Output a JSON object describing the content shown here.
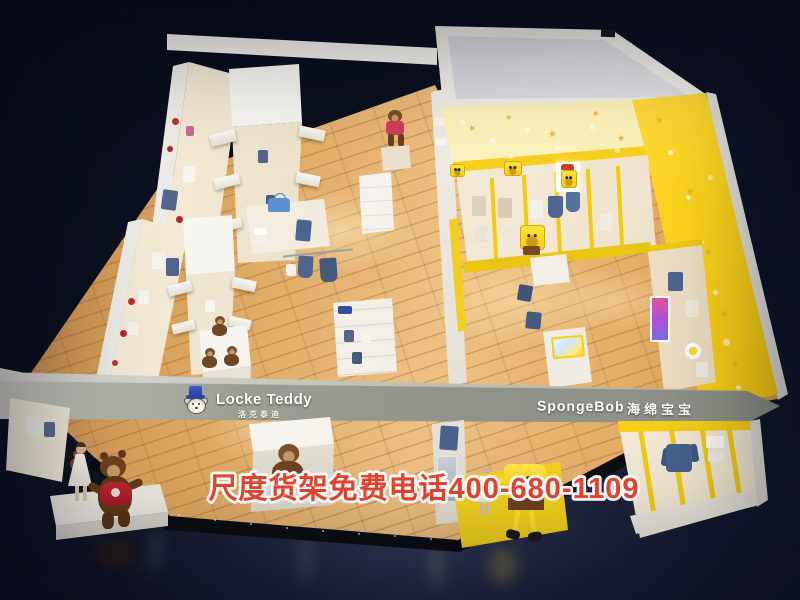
{
  "signs": {
    "locke_teddy": {
      "brand": "Locke Teddy",
      "brand_cn": "洛克泰迪"
    },
    "spongebob": {
      "brand": "SpongeBob",
      "brand_cn": "海绵宝宝"
    }
  },
  "watermark": {
    "text": "尺度货架免费电话400-680-1109"
  },
  "icons": {
    "star": "★"
  },
  "colors": {
    "background_navy": "#0d1224",
    "wood_floor": "#dda761",
    "beam_gray": "#90938a",
    "spongebob_yellow": "#ffd81f",
    "star_wall_cream": "#fdf3c4",
    "sweater_red": "#b5252c",
    "logo_hat_blue": "#3350c7",
    "watermark_red": "#e8452f"
  }
}
